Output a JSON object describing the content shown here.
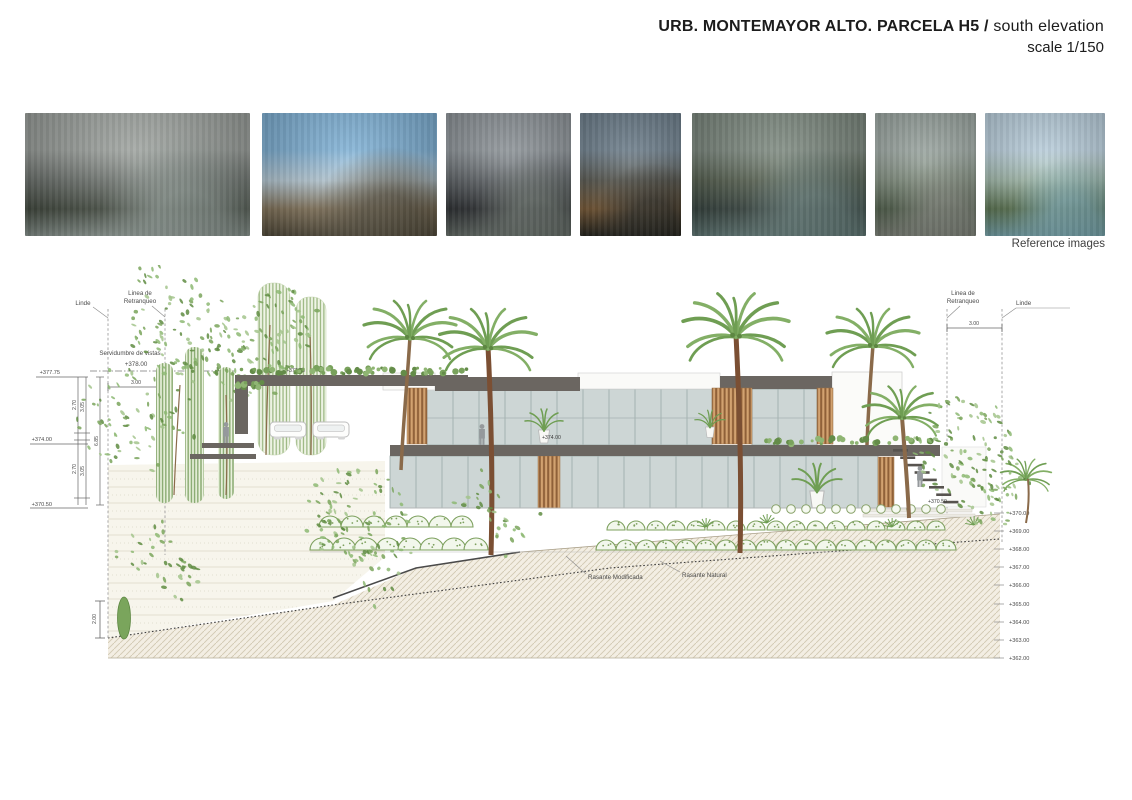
{
  "header": {
    "title_bold": "URB. MONTEMAYOR ALTO. PARCELA H5 /",
    "title_regular": "south elevation",
    "scale": "scale 1/150"
  },
  "reference_strip": {
    "caption": "Reference images",
    "images": [
      {
        "name": "concrete-pavilion-with-pool",
        "palette": [
          "#9fa4a0",
          "#6f7570",
          "#474f44",
          "#8e9a94"
        ]
      },
      {
        "name": "white-villa-palms-blue-sky",
        "palette": [
          "#7fb3d9",
          "#b9cdd9",
          "#8a7a5f",
          "#57503f"
        ]
      },
      {
        "name": "dark-stone-entrance",
        "palette": [
          "#8d9499",
          "#5a5f63",
          "#2e3134",
          "#6d7670"
        ]
      },
      {
        "name": "dusk-timber-house",
        "palette": [
          "#6a7c8a",
          "#52524a",
          "#7a5a35",
          "#2a2a24"
        ]
      },
      {
        "name": "stone-wall-pool-car-evening",
        "palette": [
          "#7d8a80",
          "#55604f",
          "#394742",
          "#67807d"
        ]
      },
      {
        "name": "terraced-hillside-house",
        "palette": [
          "#9aa5a0",
          "#7c8a7a",
          "#54644f",
          "#878c82"
        ]
      },
      {
        "name": "white-house-pool-garden",
        "palette": [
          "#bcd2e0",
          "#9fb8a8",
          "#5f7a55",
          "#7fb0b8"
        ]
      }
    ]
  },
  "elevation": {
    "labels": {
      "linde_left": "Linde",
      "linde_right": "Linde",
      "retranqueo_l1": "Linea de",
      "retranqueo_l2": "Retranqueo",
      "retranqueo_r1": "Linea de",
      "retranqueo_r2": "Retranqueo",
      "servidumbre": "Servidumbre de vistas",
      "level_378": "+378.00",
      "dim_300_left": "3.00",
      "dim_300_right": "3.00",
      "dim_200": "2.00",
      "rasante_modificada": "Rasante Modificada",
      "rasante_natural": "Rasante Natural"
    },
    "left_levels": {
      "top": "+377.75",
      "mid": "+374.00",
      "low": "+370.50"
    },
    "left_dims": {
      "a1": "2.70",
      "a2": "2.70",
      "b1": "3.05",
      "b2": "3.05",
      "total": "6.85"
    },
    "building_labels": {
      "roof": "+377.75",
      "main_floor": "+374.00",
      "terrace": "+370.50"
    },
    "right_scale": [
      "+370.00",
      "+369.00",
      "+368.00",
      "+367.00",
      "+366.00",
      "+365.00",
      "+364.00",
      "+363.00",
      "+362.00"
    ]
  },
  "colors": {
    "slab": "#6b6661",
    "glass": "#cdd6d5",
    "timber": "#c79a68",
    "vegetation": "#7da05e",
    "ground_hatch_line": "#d2c9b2",
    "annotation_text": "#4a4a4a"
  }
}
